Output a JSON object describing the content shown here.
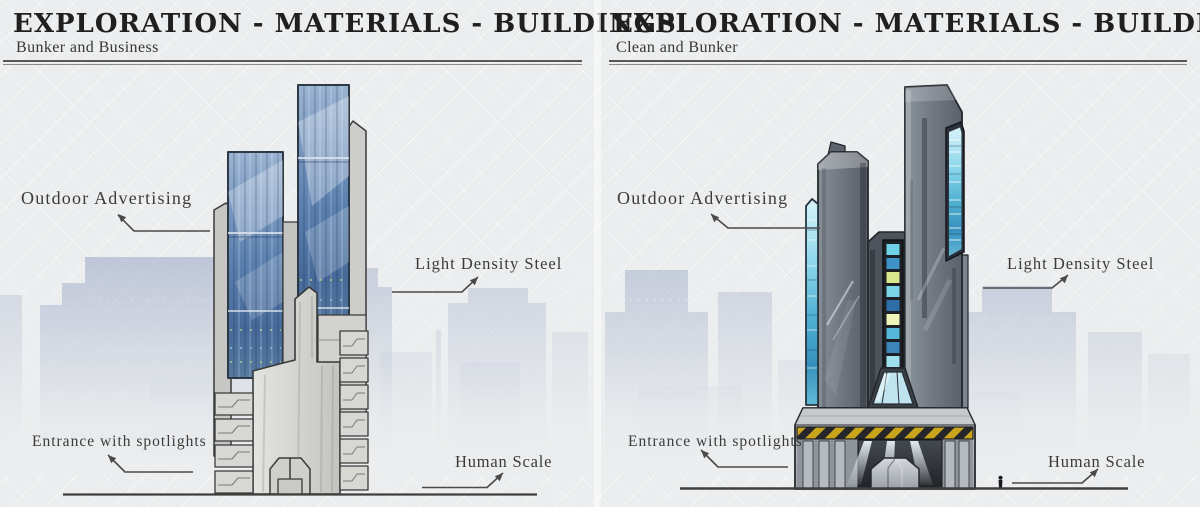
{
  "colors": {
    "background": "#ebedee",
    "ink": "#1f1f1f",
    "leader_line": "#4a4a4a",
    "glass_blue": "#5a7fae",
    "glass_cyan": "#54b4d4",
    "concrete": "#d6d7d3",
    "steel_gray": "#6e757e",
    "hazard_yellow": "#c9a51b",
    "skyline_blue": "#96a3c2"
  },
  "panels": [
    {
      "title": "EXPLORATION - MATERIALS - BUILDINGS",
      "subtitle": "Bunker and Business",
      "annotations": {
        "outdoor_advertising": "Outdoor Advertising",
        "light_density_steel": "Light Density Steel",
        "entrance_spotlights": "Entrance with spotlights",
        "human_scale": "Human Scale"
      }
    },
    {
      "title": "EXPLORATION - MATERIALS - BUILDINGS",
      "subtitle": "Clean and Bunker",
      "annotations": {
        "outdoor_advertising": "Outdoor Advertising",
        "light_density_steel": "Light Density Steel",
        "entrance_spotlights": "Entrance with spotlights",
        "human_scale": "Human Scale"
      }
    }
  ]
}
